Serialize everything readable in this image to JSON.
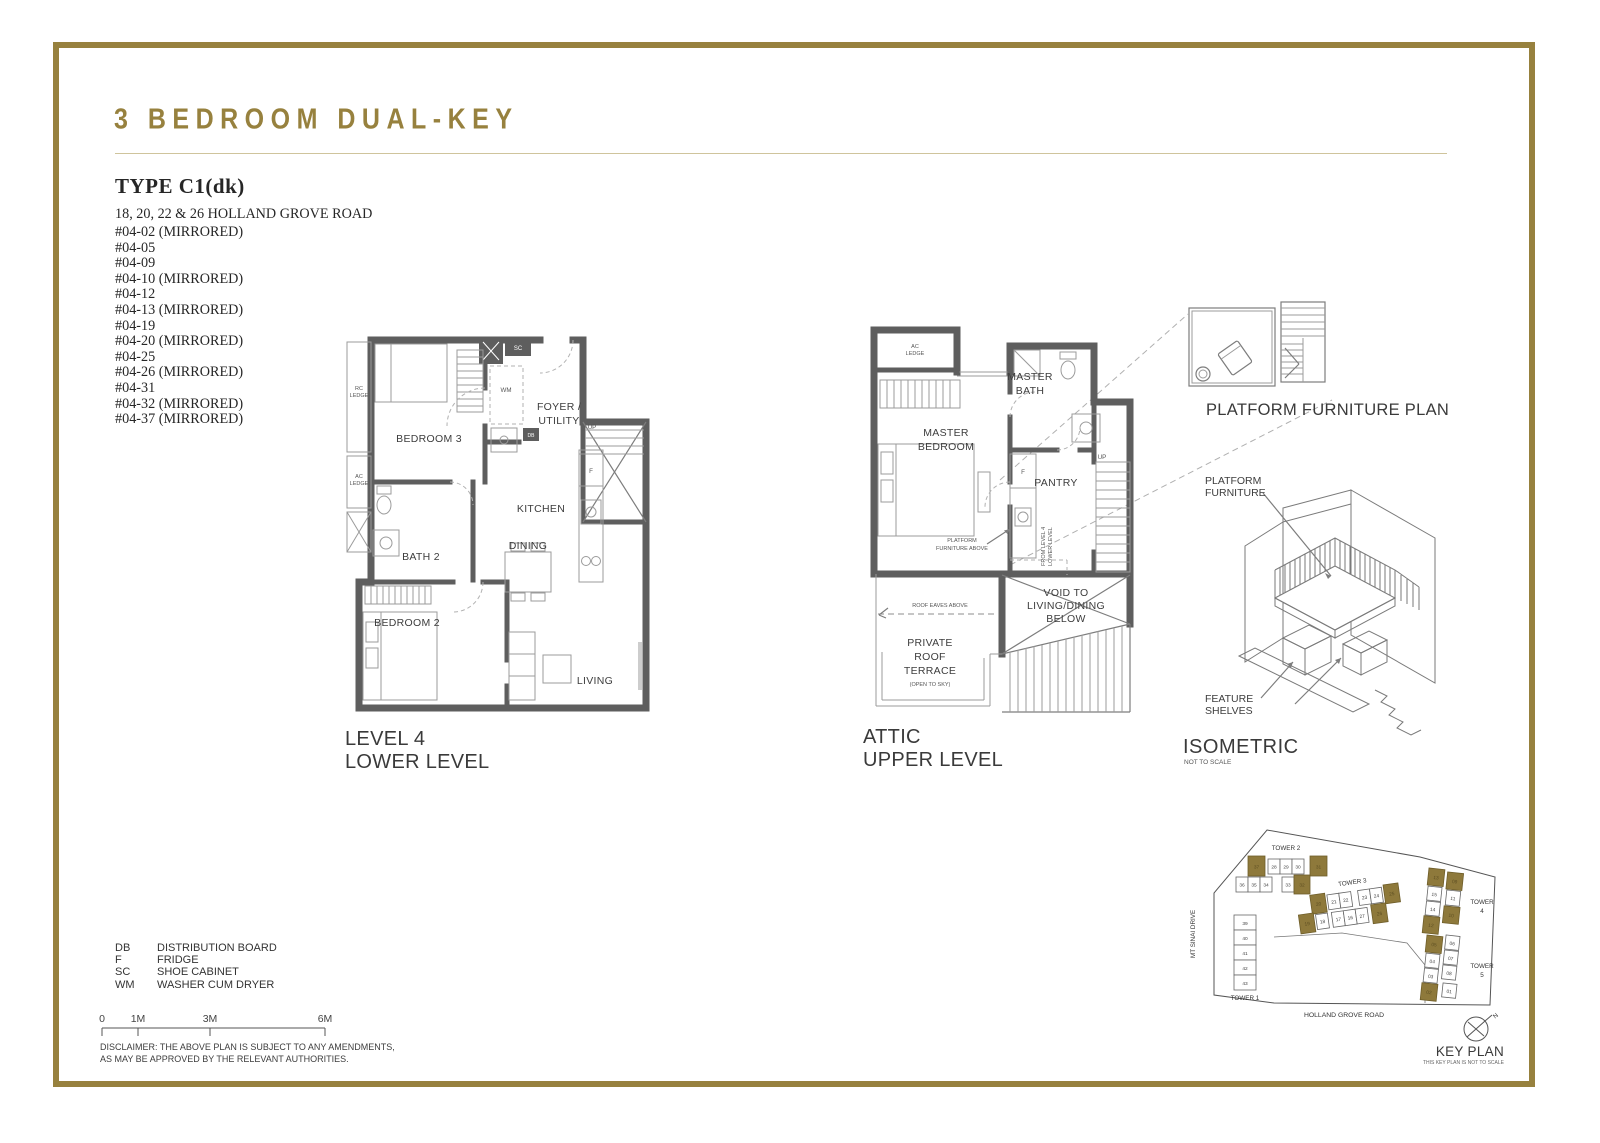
{
  "header": {
    "title": "3 BEDROOM DUAL-KEY"
  },
  "colors": {
    "gold": "#97813e",
    "wall": "#5e5e5e",
    "keyplan_highlight": "#8e793b"
  },
  "type_block": {
    "title": "TYPE C1(dk)",
    "address": "18, 20, 22 & 26 HOLLAND GROVE ROAD",
    "units": [
      "#04-02 (MIRRORED)",
      "#04-05",
      "#04-09",
      "#04-10 (MIRRORED)",
      "#04-12",
      "#04-13 (MIRRORED)",
      "#04-19",
      "#04-20 (MIRRORED)",
      "#04-25",
      "#04-26 (MIRRORED)",
      "#04-31",
      "#04-32 (MIRRORED)",
      "#04-37 (MIRRORED)"
    ]
  },
  "lower_plan": {
    "title": [
      "LEVEL 4",
      "LOWER LEVEL"
    ],
    "rooms": {
      "bedroom3": "BEDROOM 3",
      "foyer": [
        "FOYER /",
        "UTILITY"
      ],
      "kitchen": "KITCHEN",
      "bath2": "BATH 2",
      "dining": "DINING",
      "bedroom2": "BEDROOM 2",
      "living": "LIVING"
    },
    "tags": {
      "rc_ledge": [
        "RC",
        "LEDGE"
      ],
      "ac_ledge": [
        "AC",
        "LEDGE"
      ],
      "sc": "SC",
      "wm": "WM",
      "db": "DB",
      "f": "F",
      "up": "UP"
    }
  },
  "upper_plan": {
    "title": [
      "ATTIC",
      "UPPER LEVEL"
    ],
    "rooms": {
      "ac_ledge": [
        "AC",
        "LEDGE"
      ],
      "master_bath": [
        "MASTER",
        "BATH"
      ],
      "master_bedroom": [
        "MASTER",
        "BEDROOM"
      ],
      "pantry": "PANTRY",
      "void": [
        "VOID TO",
        "LIVING/DINING",
        "BELOW"
      ],
      "terrace": [
        "PRIVATE",
        "ROOF",
        "TERRACE",
        "(OPEN TO SKY)"
      ]
    },
    "tags": {
      "f": "F",
      "up": "UP",
      "roof_eaves": "ROOF EAVES ABOVE",
      "platform_above": [
        "PLATFORM",
        "FURNITURE ABOVE"
      ],
      "from_level": [
        "FROM LEVEL 4",
        "LOWER LEVEL"
      ]
    }
  },
  "platform_plan": {
    "title": "PLATFORM FURNITURE PLAN"
  },
  "isometric": {
    "title": "ISOMETRIC",
    "subtitle": "NOT TO SCALE",
    "platform_label": [
      "PLATFORM",
      "FURNITURE"
    ],
    "shelves_label": [
      "FEATURE",
      "SHELVES"
    ]
  },
  "legend": {
    "rows": [
      {
        "abbr": "DB",
        "desc": "DISTRIBUTION BOARD"
      },
      {
        "abbr": "F",
        "desc": "FRIDGE"
      },
      {
        "abbr": "SC",
        "desc": "SHOE CABINET"
      },
      {
        "abbr": "WM",
        "desc": "WASHER CUM DRYER"
      }
    ]
  },
  "scalebar": {
    "ticks": [
      "0",
      "1M",
      "3M",
      "6M"
    ]
  },
  "disclaimer": {
    "line1": "DISCLAIMER: THE ABOVE PLAN IS SUBJECT TO ANY AMENDMENTS,",
    "line2": "AS MAY BE APPROVED BY THE RELEVANT AUTHORITIES."
  },
  "keyplan": {
    "title": "KEY PLAN",
    "subtitle": "THIS KEY PLAN IS NOT TO SCALE",
    "compass": "N",
    "roads": {
      "left": "MT SINAI DRIVE",
      "bottom": "HOLLAND GROVE ROAD"
    },
    "towers": [
      {
        "name": "TOWER 1",
        "units": [
          {
            "label": "39"
          },
          {
            "label": "40"
          },
          {
            "label": "41"
          },
          {
            "label": "42"
          },
          {
            "label": "43"
          }
        ]
      },
      {
        "name": "TOWER 2",
        "units": [
          {
            "label": "37",
            "gold": true
          },
          {
            "label": "28"
          },
          {
            "label": "29"
          },
          {
            "label": "30"
          },
          {
            "label": "31",
            "gold": true
          },
          {
            "label": "36"
          },
          {
            "label": "35"
          },
          {
            "label": "34"
          },
          {
            "label": "33"
          },
          {
            "label": "32",
            "gold": true
          }
        ]
      },
      {
        "name": "TOWER 3",
        "units": [
          {
            "label": "20",
            "gold": true
          },
          {
            "label": "21"
          },
          {
            "label": "22"
          },
          {
            "label": "23"
          },
          {
            "label": "24"
          },
          {
            "label": "25",
            "gold": true
          },
          {
            "label": "19",
            "gold": true
          },
          {
            "label": "18"
          },
          {
            "label": "17"
          },
          {
            "label": "16"
          },
          {
            "label": "27"
          },
          {
            "label": "26",
            "gold": true
          }
        ]
      },
      {
        "name": "TOWER 4",
        "name_lines": [
          "TOWER",
          "4"
        ],
        "units": [
          {
            "label": "13",
            "gold": true
          },
          {
            "label": "15"
          },
          {
            "label": "14"
          },
          {
            "label": "12",
            "gold": true
          },
          {
            "label": "09",
            "gold": true
          },
          {
            "label": "11"
          },
          {
            "label": "10",
            "gold": true
          }
        ]
      },
      {
        "name": "TOWER 5",
        "name_lines": [
          "TOWER",
          "5"
        ],
        "units": [
          {
            "label": "05",
            "gold": true
          },
          {
            "label": "04"
          },
          {
            "label": "03"
          },
          {
            "label": "02",
            "gold": true
          },
          {
            "label": "06"
          },
          {
            "label": "07"
          },
          {
            "label": "08"
          },
          {
            "label": "01"
          }
        ]
      }
    ]
  }
}
